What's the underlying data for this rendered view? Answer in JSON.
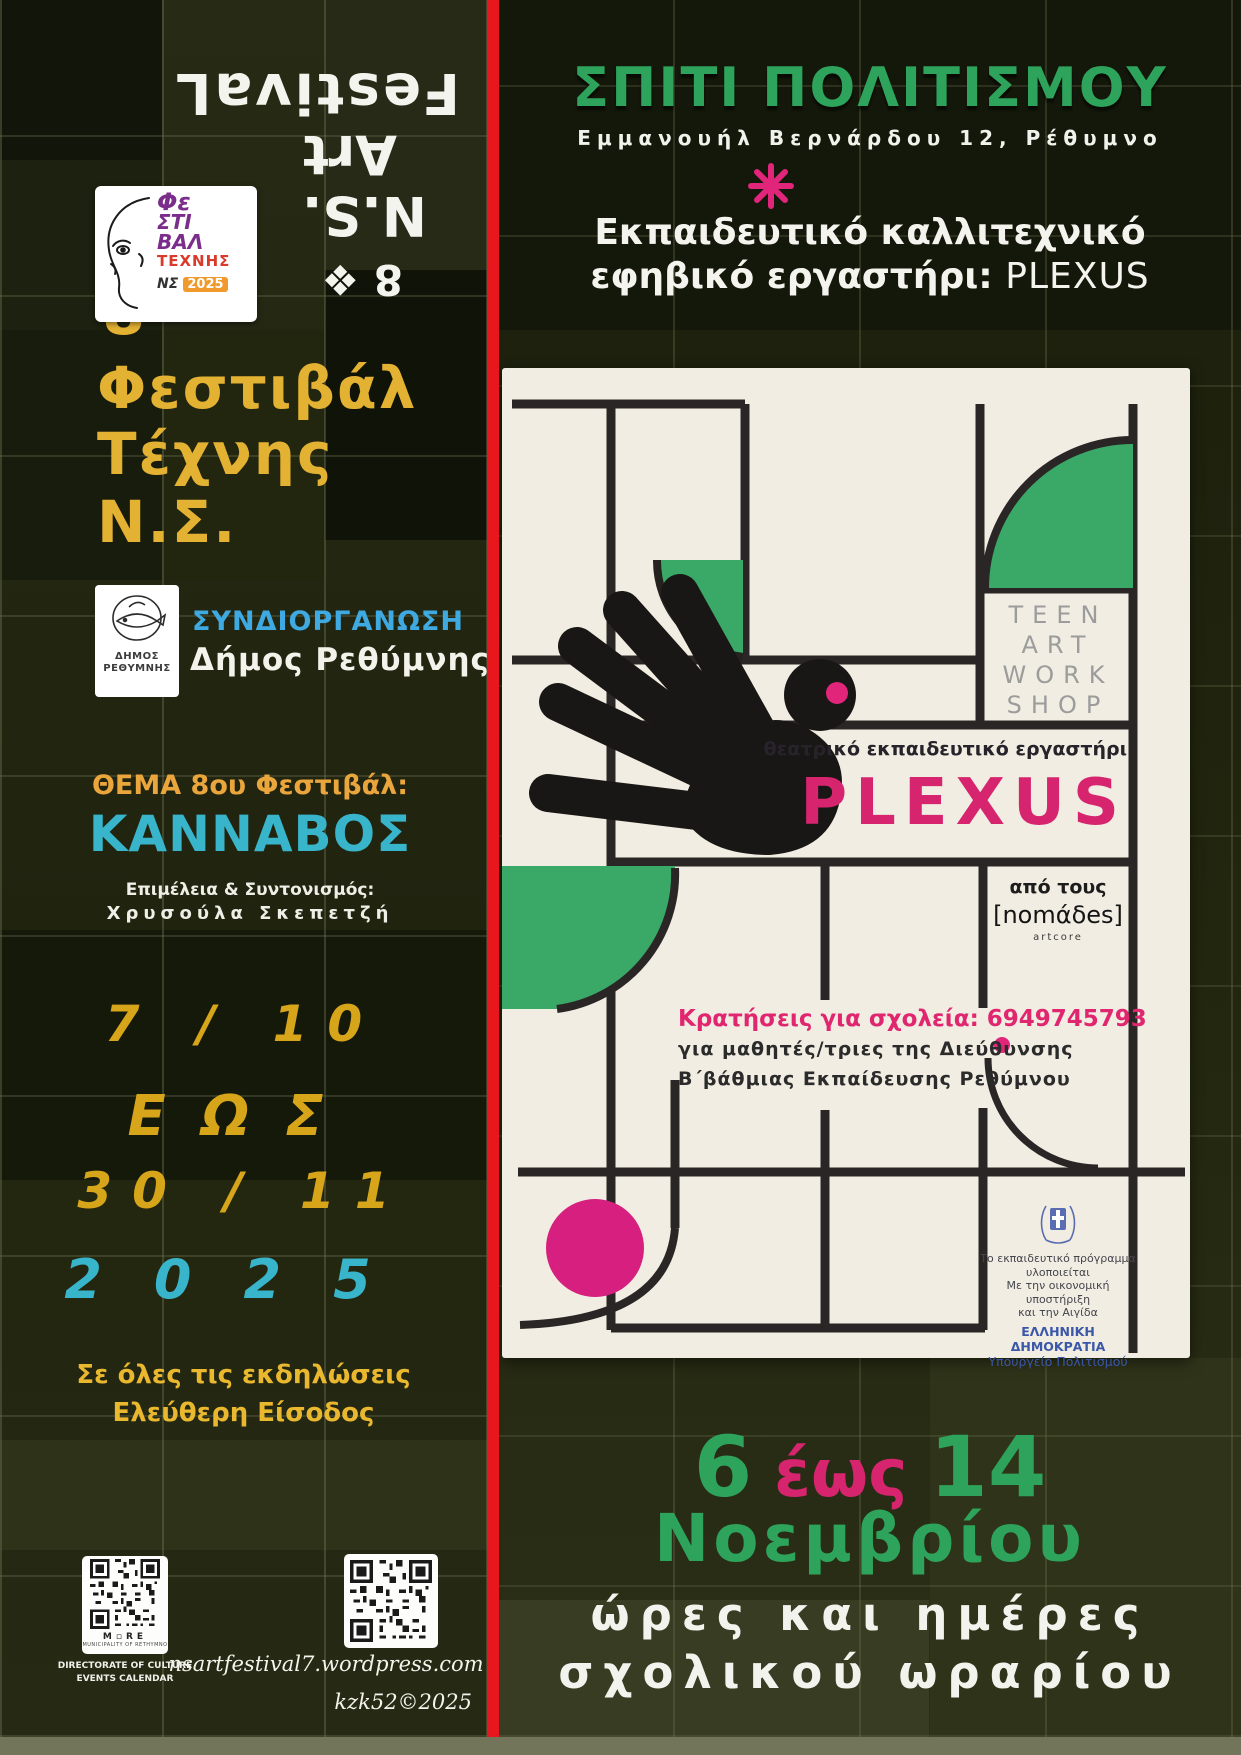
{
  "palette": {
    "bg_olive": "#242813",
    "red_stripe": "#e8171d",
    "gold": "#e4b233",
    "gold_deep": "#d6a51a",
    "orange": "#eaa63c",
    "cyan": "#38b5ca",
    "blue": "#3fa9e1",
    "green": "#2ea35b",
    "poster_green": "#3aa968",
    "magenta": "#d6256e",
    "cream": "#f1ede2",
    "grid_black": "#2b2626",
    "teen_gray": "#9c9c9c",
    "ministry_blue": "#3a57a8",
    "strip_olive": "#72755a"
  },
  "left": {
    "rotated": {
      "festival": "FestivaL",
      "art": "Art",
      "ns": "N.S.",
      "eight": "8 ❖"
    },
    "logo_card": {
      "fe": "Φε",
      "sti": "ΣΤΙ",
      "bal": "ΒΑΛ",
      "texnis": "ΤΕΧΝΗΣ",
      "ns_mark": "ΝΣ",
      "year": "2025"
    },
    "eight": "8",
    "eight_ornament": "❖",
    "title_line1": "Φεστιβάλ",
    "title_line2": "Τέχνης",
    "title_line3": "Ν.Σ.",
    "coorganization_label": "ΣΥΝΔΙΟΡΓΑΝΩΣΗ",
    "coorganizer": "Δήμος Ρεθύμνης",
    "municipality_logo": {
      "line1": "ΔΗΜΟΣ",
      "line2": "ΡΕΘΥΜΝΗΣ"
    },
    "theme_label": "ΘΕΜΑ 8ου Φεστιβάλ:",
    "theme_value": "ΚΑΝΝΑΒΟΣ",
    "curation_label": "Επιμέλεια & Συντονισμός:",
    "curator_name": "Χρυσούλα Σκεπετζή",
    "date_start": "7 / 10",
    "date_connector": "ΕΩΣ",
    "date_end": "30 / 11",
    "date_year": "2025",
    "free_entry_line1": "Σε όλες τις εκδηλώσεις",
    "free_entry_line2": "Ελεύθερη Είσοδος",
    "qr_municipality": {
      "brand": "M▫RE",
      "brand_sub": "MUNICIPALITY OF RETHYMNO",
      "caption_line1": "DIRECTORATE OF CULTURE",
      "caption_line2": "EVENTS CALENDAR"
    },
    "website": "nsartfestival7.wordpress.com",
    "credit": "kzk52©2025"
  },
  "right": {
    "venue": "ΣΠΙΤΙ ΠΟΛΙΤΙΣΜΟΥ",
    "address": "Εμμανουήλ Βερνάρδου 12, Ρέθυμνο",
    "workshop_title_line1": "Εκπαιδευτικό καλλιτεχνικό",
    "workshop_title_line2": "εφηβικό εργαστήρι:",
    "workshop_title_name": "PLEXUS",
    "dates": {
      "day_from": "6",
      "connector": "έως",
      "day_to": "14",
      "month": "Νοεμβρίου",
      "schedule_line1": "ώρες και ημέρες",
      "schedule_line2": "σχολικού ωραρίου"
    }
  },
  "card": {
    "teen": [
      "TEEN",
      "ART",
      "WORK",
      "SHOP"
    ],
    "theater_line": "θεατρικό εκπαιδευτικό εργαστήρι",
    "plexus": "PLEXUS",
    "by_label": "από τους",
    "group_name": "[nomάδes]",
    "group_sub": "artcore",
    "booking_line1": "Κρατήσεις για σχολεία: 6949745793",
    "booking_line2": "για μαθητές/τριες της Διεύθυνσης",
    "booking_line3": "Β΄βάθμιας Εκπαίδευσης Ρεθύμνου",
    "ministry": {
      "line1": "Το εκπαιδευτικό πρόγραμμα",
      "line2": "υλοποιείται",
      "line3": "Με την οικονομική υποστήριξη",
      "line4": "και την Αιγίδα",
      "line5": "ΕΛΛΗΝΙΚΗ ΔΗΜΟΚΡΑΤΙΑ",
      "line6": "Υπουργείο Πολιτισμού"
    }
  }
}
